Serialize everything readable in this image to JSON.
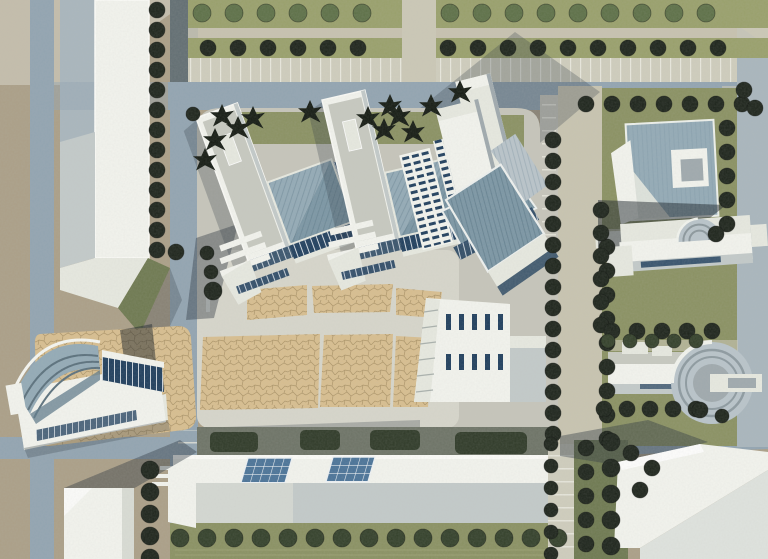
{
  "meta": {
    "title": "Aerial photograph of an architectural urban-design scale model"
  },
  "colors": {
    "base_tan": "#ab9f87",
    "haze": "#d8d6c8",
    "road": "#92a4b1",
    "road_light": "#a9b6bd",
    "road_dark": "#626e72",
    "street": "#c8c4b0",
    "concrete": "#c6c5ba",
    "concrete_light": "#d7d6cb",
    "path_light": "#cbc8b6",
    "parking": "#cfcdbd",
    "lawn": "#8a9162",
    "lawn_top": "#99a06b",
    "lawn_dark": "#6e7950",
    "hedge": "#2f3a28",
    "tree_dark": "#1d241b",
    "tree_mid": "#33402a",
    "tree_light": "#5d7047",
    "conifer": "#141a12",
    "white": "#f3f4ee",
    "white_dim": "#e7e9e0",
    "face_shade": "#c3cac9",
    "face_gray": "#9fa9ad",
    "roof_top": "#c7c9c0",
    "ridge": "#7b96a4",
    "ridge_light": "#93aab6",
    "ridge_dark": "#5e7a89",
    "roof_flat": "#b9c4ca",
    "glass": "#1f3e5d",
    "glass_blue": "#4a7398",
    "plaza": "#d8be8f",
    "plaza_line": "#a38b5e",
    "shadow": "rgba(42,52,62,0.42)",
    "shadow_soft": "rgba(48,58,68,0.28)",
    "shadow_dark": "rgba(25,33,40,0.5)"
  },
  "scene": {
    "districts": [
      "northwest slab building",
      "tree-lined boulevards",
      "central superblock with tilted housing complexes",
      "white office towers",
      "tan crazy-paved central plaza",
      "curved-roof auditorium west",
      "northeast courtyard building",
      "east villa with quarter-cylinder",
      "east rotunda building",
      "long south building with blue skylights",
      "southeast angled slab building"
    ]
  },
  "trees": {
    "rows": [
      {
        "x": 202,
        "y": 13,
        "dx": 32,
        "dy": 0,
        "n": 6,
        "r": 9,
        "c": "tree_light"
      },
      {
        "x": 450,
        "y": 13,
        "dx": 32,
        "dy": 0,
        "n": 9,
        "r": 9,
        "c": "tree_light"
      },
      {
        "x": 208,
        "y": 48,
        "dx": 30,
        "dy": 0,
        "n": 6,
        "r": 8,
        "c": "tree_dark"
      },
      {
        "x": 448,
        "y": 48,
        "dx": 30,
        "dy": 0,
        "n": 10,
        "r": 8,
        "c": "tree_dark"
      },
      {
        "x": 157,
        "y": 10,
        "dx": 0,
        "dy": 20,
        "n": 13,
        "r": 8,
        "c": "tree_dark"
      },
      {
        "x": 150,
        "y": 470,
        "dx": 0,
        "dy": 22,
        "n": 5,
        "r": 9,
        "c": "tree_dark"
      },
      {
        "x": 553,
        "y": 140,
        "dx": 0,
        "dy": 21,
        "n": 15,
        "r": 8,
        "c": "tree_dark"
      },
      {
        "x": 607,
        "y": 247,
        "dx": 0,
        "dy": 24,
        "n": 9,
        "r": 8,
        "c": "tree_dark"
      },
      {
        "x": 586,
        "y": 104,
        "dx": 26,
        "dy": 0,
        "n": 7,
        "r": 8,
        "c": "tree_dark"
      },
      {
        "x": 727,
        "y": 128,
        "dx": 0,
        "dy": 24,
        "n": 5,
        "r": 8,
        "c": "tree_dark"
      },
      {
        "x": 601,
        "y": 210,
        "dx": 0,
        "dy": 23,
        "n": 6,
        "r": 8,
        "c": "tree_dark"
      },
      {
        "x": 612,
        "y": 331,
        "dx": 25,
        "dy": 0,
        "n": 5,
        "r": 8,
        "c": "tree_dark"
      },
      {
        "x": 608,
        "y": 341,
        "dx": 22,
        "dy": 0,
        "n": 5,
        "r": 7,
        "c": "tree_mid"
      },
      {
        "x": 604,
        "y": 409,
        "dx": 23,
        "dy": 0,
        "n": 5,
        "r": 8,
        "c": "tree_dark"
      },
      {
        "x": 180,
        "y": 538,
        "dx": 27,
        "dy": 0,
        "n": 15,
        "r": 9,
        "c": "tree_mid"
      },
      {
        "x": 551,
        "y": 444,
        "dx": 0,
        "dy": 22,
        "n": 6,
        "r": 7,
        "c": "tree_dark"
      },
      {
        "x": 586,
        "y": 448,
        "dx": 0,
        "dy": 24,
        "n": 5,
        "r": 8,
        "c": "tree_dark"
      },
      {
        "x": 611,
        "y": 442,
        "dx": 0,
        "dy": 26,
        "n": 5,
        "r": 9,
        "c": "tree_dark"
      }
    ],
    "singles": [
      [
        631,
        453,
        8
      ],
      [
        652,
        468,
        8
      ],
      [
        640,
        490,
        8
      ],
      [
        213,
        291,
        9
      ],
      [
        207,
        253,
        7
      ],
      [
        211,
        272,
        7
      ],
      [
        755,
        108,
        8
      ],
      [
        744,
        90,
        8
      ],
      [
        716,
        234,
        8
      ],
      [
        700,
        410,
        8
      ],
      [
        722,
        416,
        7
      ],
      [
        176,
        252,
        8
      ],
      [
        193,
        114,
        7
      ]
    ],
    "conifers": [
      [
        222,
        116
      ],
      [
        238,
        128
      ],
      [
        253,
        118
      ],
      [
        215,
        140
      ],
      [
        310,
        112
      ],
      [
        368,
        118
      ],
      [
        384,
        130
      ],
      [
        399,
        116
      ],
      [
        413,
        132
      ],
      [
        431,
        106
      ],
      [
        390,
        106
      ],
      [
        460,
        92
      ],
      [
        205,
        160
      ]
    ]
  }
}
